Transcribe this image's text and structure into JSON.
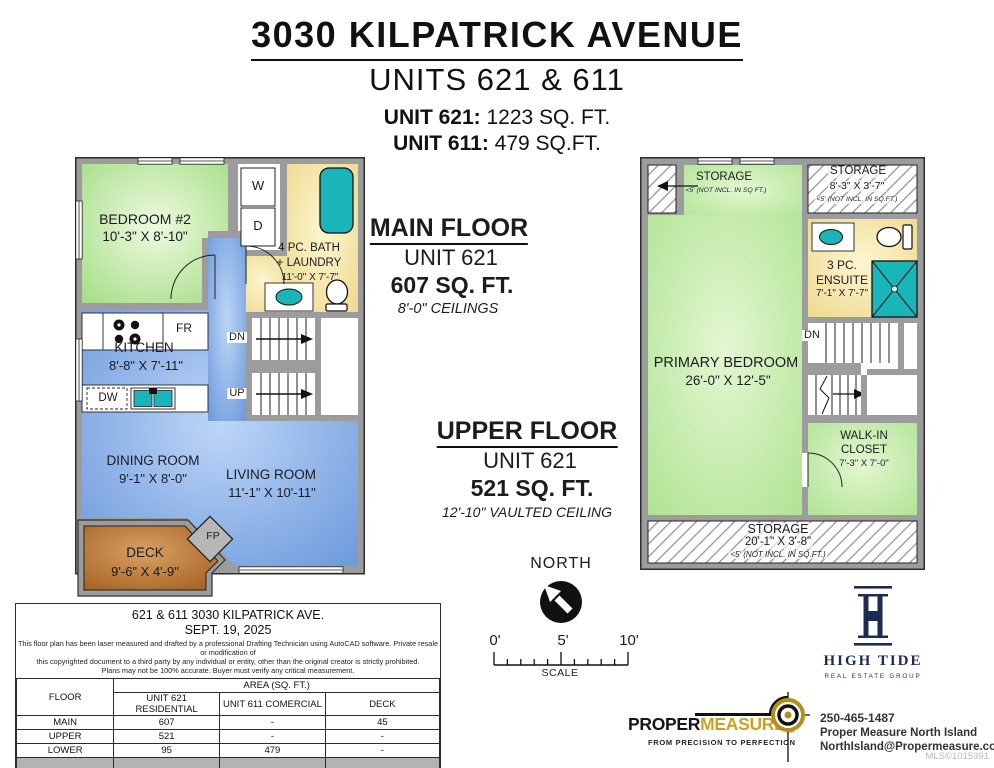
{
  "header": {
    "address": "3030 KILPATRICK AVENUE",
    "units_line": "UNITS 621 & 611",
    "unit621_label": "UNIT 621:",
    "unit621_area": "1223 SQ. FT.",
    "unit611_label": "UNIT 611:",
    "unit611_area": "479 SQ.FT."
  },
  "main_floor": {
    "bedroom2_name": "BEDROOM #2",
    "bedroom2_dims": "10'-3\" X 8'-10\"",
    "washer": "W",
    "dryer": "D",
    "bath_line1": "4 PC. BATH",
    "bath_line2": "+ LAUNDRY",
    "bath_dims": "11'-0\" X 7'-7\"",
    "kitchen_name": "KITCHEN",
    "kitchen_dims": "8'-8\" X 7'-11\"",
    "fridge": "FR",
    "dishwasher": "DW",
    "down": "DN",
    "up": "UP",
    "dining_name": "DINING ROOM",
    "dining_dims": "9'-1\" X 8'-0\"",
    "living_name": "LIVING ROOM",
    "living_dims": "11'-1\" X 10'-11\"",
    "deck_name": "DECK",
    "deck_dims": "9'-6\" X 4'-9\"",
    "fireplace": "FP"
  },
  "upper_floor": {
    "storage_left_name": "STORAGE",
    "storage_left_note": "<5' (NOT INCL. IN SQ FT.)",
    "storage_right_name": "STORAGE",
    "storage_right_dims": "8'-3\" X 3'-7\"",
    "storage_right_note": "<5' (NOT INCL. IN SQ.FT.)",
    "ensuite_line1": "3 PC.",
    "ensuite_line2": "ENSUITE",
    "ensuite_dims": "7'-1\" X 7'-7\"",
    "down": "DN",
    "primary_name": "PRIMARY BEDROOM",
    "primary_dims": "26'-0\" X 12'-5\"",
    "closet_line1": "WALK-IN",
    "closet_line2": "CLOSET",
    "closet_dims": "7'-3\" X 7'-0\"",
    "storage_bottom_name": "STORAGE",
    "storage_bottom_dims": "20'-1\" X 3'-8\"",
    "storage_bottom_note": "<5' (NOT INCL. IN SQ.FT.)"
  },
  "annotations": {
    "main_title": "MAIN FLOOR",
    "main_unit": "UNIT 621",
    "main_area": "607 SQ. FT.",
    "main_ceiling": "8'-0\" CEILINGS",
    "upper_title": "UPPER FLOOR",
    "upper_unit": "UNIT 621",
    "upper_area": "521 SQ. FT.",
    "upper_ceiling": "12'-10\" VAULTED CEILING",
    "north": "NORTH",
    "scale_0": "0'",
    "scale_5": "5'",
    "scale_10": "10'",
    "scale_label": "SCALE"
  },
  "info_table": {
    "title": "621 & 611 3030 KILPATRICK AVE.",
    "date": "SEPT. 19, 2025",
    "disclaimer_line1": "This floor plan has been laser measured and drafted by a professional Drafting Technician using AutoCAD software. Private resale or modification of",
    "disclaimer_line2": "this copyrighted document to a third party by any individual or entity, other than the original creator is strictly prohibited.",
    "disclaimer_line3": "Plans may not be 100% accurate.  Buyer must verify any critical measurement.",
    "floor_header": "FLOOR",
    "area_header": "AREA (SQ. FT.)",
    "col_unit621": "UNIT 621 RESIDENTIAL",
    "col_unit611": "UNIT 611 COMERCIAL",
    "col_deck": "DECK",
    "rows": [
      {
        "floor": "MAIN",
        "unit621": "607",
        "unit611": "-",
        "deck": "45"
      },
      {
        "floor": "UPPER",
        "unit621": "521",
        "unit611": "-",
        "deck": "-"
      },
      {
        "floor": "LOWER",
        "unit621": "95",
        "unit611": "479",
        "deck": "-"
      }
    ],
    "total_row": {
      "floor": "TOTAL",
      "unit621": "1223",
      "unit611": "479",
      "deck": "45"
    }
  },
  "branding": {
    "hightide_name": "HIGH TIDE",
    "hightide_tagline": "REAL ESTATE GROUP",
    "pm_part1": "PROPER",
    "pm_part2": "MEASURE",
    "pm_tm": "TM",
    "pm_tagline": "FROM PRECISION TO PERFECTION",
    "phone": "250-465-1487",
    "company": "Proper Measure North Island",
    "email": "NorthIsland@Propermeasure.com",
    "mls": "MLS©1015391"
  },
  "colors": {
    "wall": "#9c9c9c",
    "room_green": "#b9e798",
    "room_blue": "#7fa6e3",
    "room_yellow": "#f2e09a",
    "deck_brown": "#bb7a35",
    "fixture_teal": "#1ab5b9",
    "hightide_navy": "#1d2b50",
    "pm_gold": "#c9a227"
  }
}
